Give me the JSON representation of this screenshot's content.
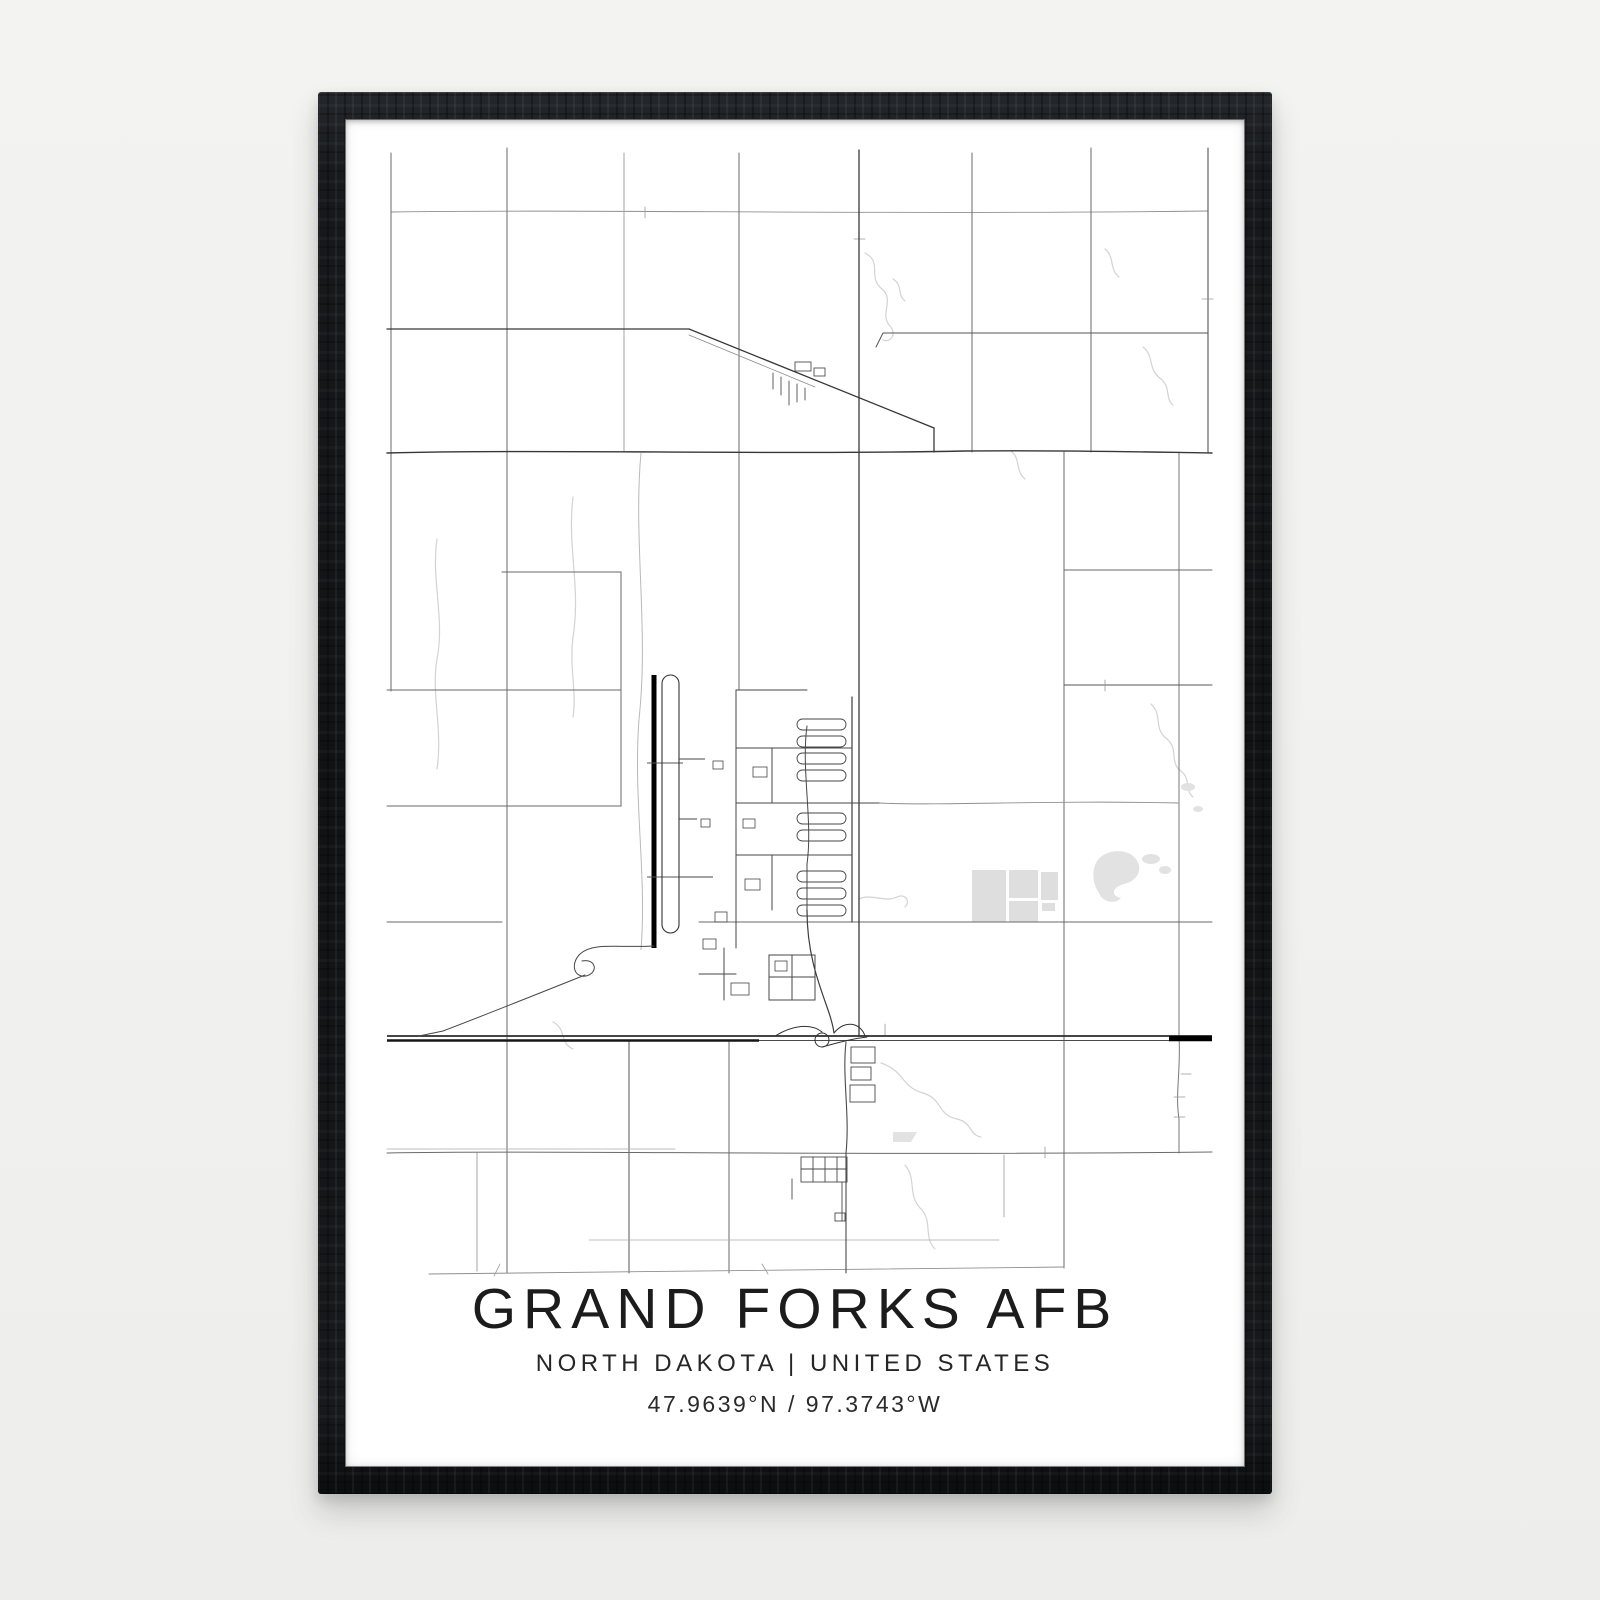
{
  "scene": {
    "type": "framed minimalist map poster on wall",
    "wall_color": "#f1f1ef"
  },
  "frame": {
    "style": "black wood frame",
    "color": "#141619"
  },
  "poster": {
    "title": "GRAND FORKS AFB",
    "subtitle": "NORTH DAKOTA | UNITED STATES",
    "coordinates": "47.9639°N / 97.3743°W",
    "background": "#ffffff",
    "text_color": "#1e1e1e"
  },
  "map": {
    "style": "minimalist monochrome street map",
    "features": [
      "rural section-road grid",
      "north-south runway with parallel taxiway",
      "air base street network with cul-de-sac housing fingers",
      "east-west highway with interchange",
      "small town along diagonal rail road",
      "gray building footprints",
      "ponds and stream meanders"
    ],
    "colors": {
      "roads_major": "#383838",
      "roads_minor": "#6a6a6a",
      "roads_faint": "#9a9a9a",
      "runway": "#000000",
      "water": "#d3d3d3",
      "buildings": "#dedede"
    }
  }
}
